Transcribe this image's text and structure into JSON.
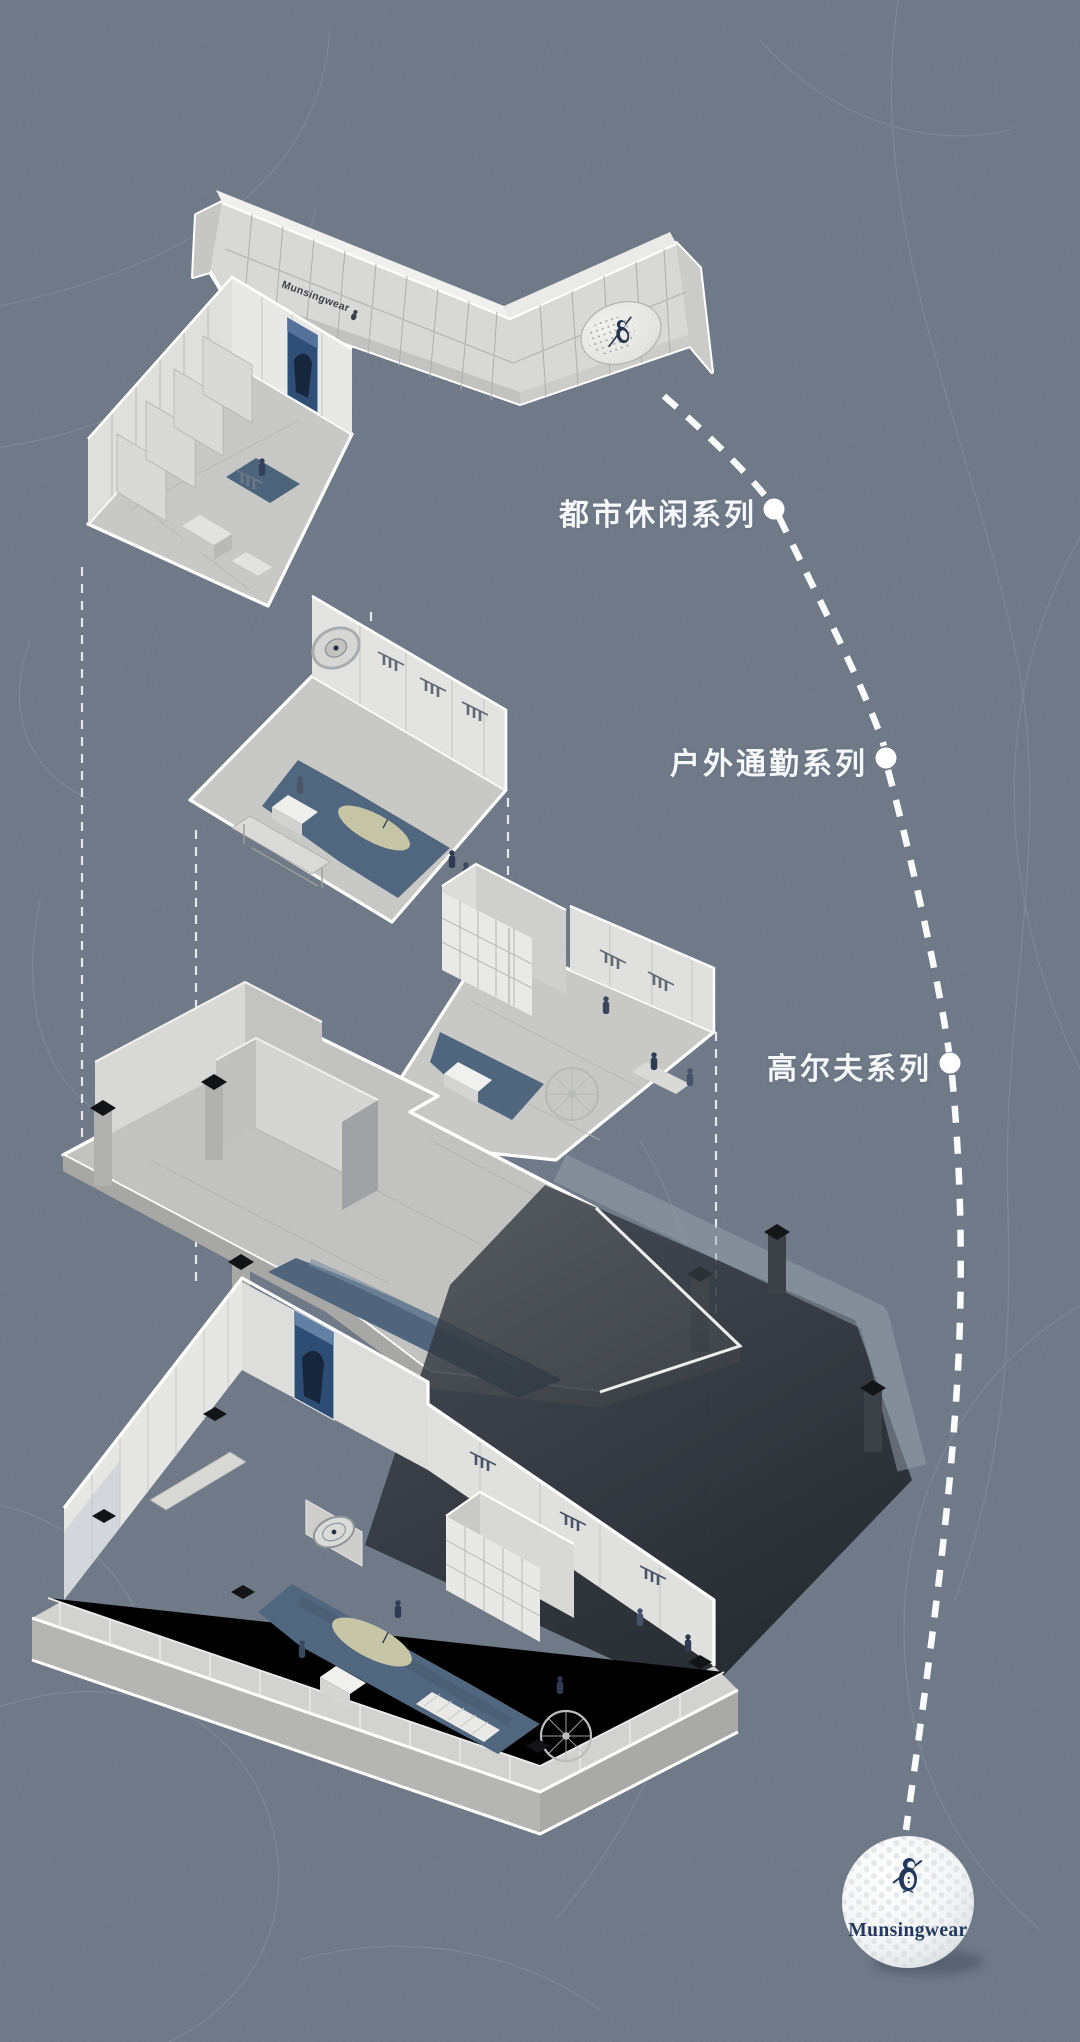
{
  "brand": {
    "facade_sign": "Munsingwear",
    "ball_wordmark": "Munsingwear"
  },
  "series_labels": [
    {
      "id": "urban-casual",
      "label": "都市休闲系列"
    },
    {
      "id": "outdoor-commuter",
      "label": "户外通勤系列"
    },
    {
      "id": "golf",
      "label": "高尔夫系列"
    }
  ],
  "colors": {
    "background": "#6a7482",
    "contour_line": "#9aa4b0",
    "outline_white": "#ffffff",
    "plate_grey": "#c8c9c7",
    "wall_grey": "#e3e3e1",
    "carpet_blue": "#51677f",
    "poster_navy": "#2e4d74",
    "logo_navy": "#22395c",
    "shadow_dark": "#2c3138",
    "golf_green": "#c6c5a6"
  }
}
